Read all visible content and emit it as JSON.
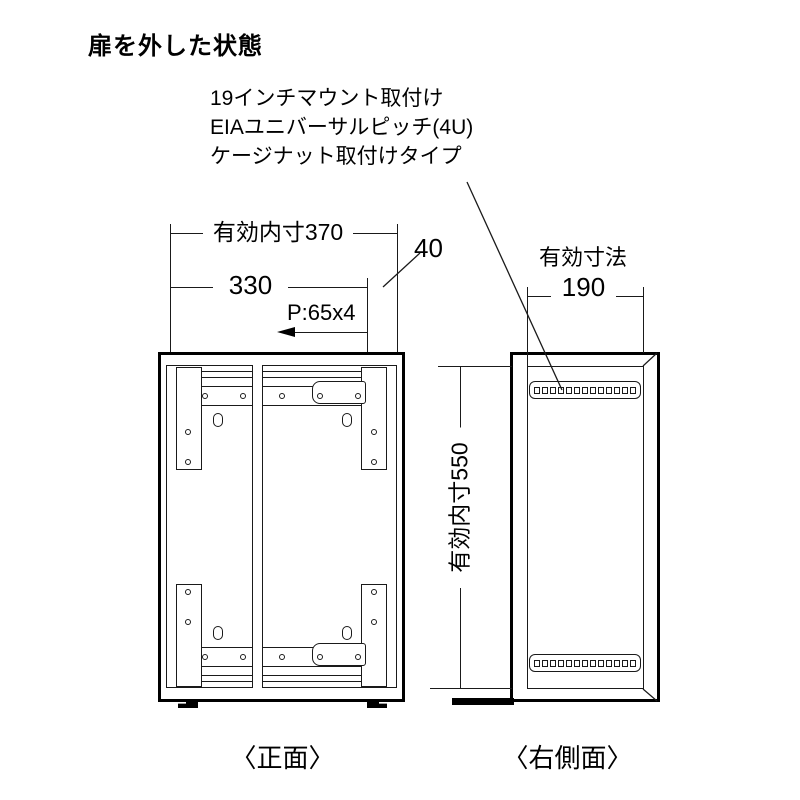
{
  "title": "扉を外した状態",
  "annotation": {
    "line1": "19インチマウント取付け",
    "line2": "EIAユニバーサルピッチ(4U)",
    "line3": "ケージナット取付けタイプ"
  },
  "front_view": {
    "caption": "〈正面〉",
    "dim_inner_width": "有効内寸370",
    "dim_rail_width": "330",
    "dim_side_offset": "40",
    "dim_hole_pitch": "P:65x4",
    "rail_hole_count": 5,
    "corner_rail_hole_count": 2,
    "slot_count": 4
  },
  "side_view": {
    "caption": "〈右側面〉",
    "dim_depth_label": "有効寸法",
    "dim_depth_value": "190",
    "dim_inner_height": "有効内寸550",
    "cage_nut_squares_per_strip": 13
  },
  "colors": {
    "line": "#000000",
    "background": "#ffffff"
  }
}
